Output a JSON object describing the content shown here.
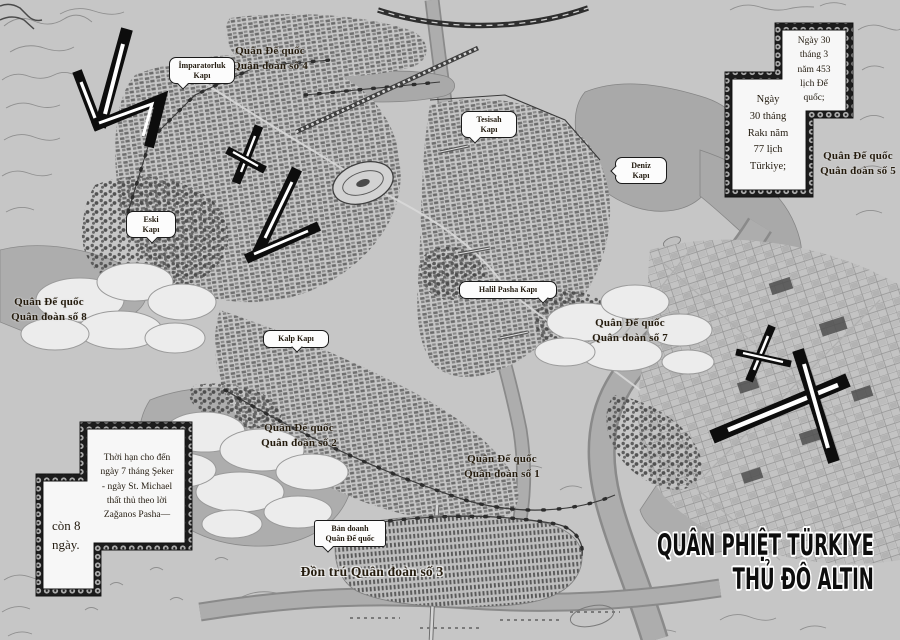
{
  "colors": {
    "background": "#c6c6c6",
    "water": "#a9a9a9",
    "ink": "#1c1c1c",
    "label_text": "#241b0d",
    "bubble_bg": "#fcfcfc",
    "title_fill": "#0d0d0d",
    "title_outline": "#ffffff"
  },
  "gates": {
    "imparatorluk": {
      "lines": [
        "İmparatorluk",
        "Kapı"
      ]
    },
    "tesisah": {
      "lines": [
        "Tesisah",
        "Kapı"
      ]
    },
    "deniz": {
      "lines": [
        "Deniz",
        "Kapı"
      ]
    },
    "eski": {
      "lines": [
        "Eski",
        "Kapı"
      ]
    },
    "halil": {
      "lines": [
        "Halil Pasha Kapı"
      ]
    },
    "kalp": {
      "lines": [
        "Kalp Kapı"
      ]
    },
    "hq": {
      "lines": [
        "Bản doanh",
        "Quân Đế quốc"
      ]
    }
  },
  "armies": {
    "a4": {
      "lines": [
        "Quân Đế quốc",
        "Quân đoàn số 4"
      ]
    },
    "a5": {
      "lines": [
        "Quân Đế quốc",
        "Quân đoàn số 5"
      ]
    },
    "a8": {
      "lines": [
        "Quân Đế quốc",
        "Quân đoàn số 8"
      ]
    },
    "a7": {
      "lines": [
        "Quân Đế quốc",
        "Quân đoàn số 7"
      ]
    },
    "a2": {
      "lines": [
        "Quân Đế quốc",
        "Quân đoàn số 2"
      ]
    },
    "a1": {
      "lines": [
        "Quân Đế quốc",
        "Quân đoàn số 1"
      ]
    },
    "a3": {
      "lines": [
        "Đồn trú Quân đoàn số 3"
      ]
    }
  },
  "boxes": {
    "date_right": {
      "lines": [
        "Ngày 30",
        "tháng 3",
        "năm 453",
        "lịch Đế",
        "quốc;"
      ]
    },
    "date_left": {
      "lines": [
        "Ngày",
        "30 tháng",
        "Rakı năm",
        "77 lịch",
        "Türkiye;"
      ]
    },
    "deadline": {
      "lines": [
        "Thời hạn cho đến",
        "ngày 7 tháng Şeker",
        "- ngày St. Michael",
        "thất thủ theo lời",
        "Zağanos Pasha—"
      ]
    },
    "countdown": {
      "lines": [
        "còn 8",
        "ngày."
      ]
    }
  },
  "title": {
    "lines": [
      "QUÂN PHIỆT TÜRKIYE",
      "THỦ ĐÔ ALTIN"
    ]
  },
  "decorations": {
    "brush_marks": 5
  }
}
